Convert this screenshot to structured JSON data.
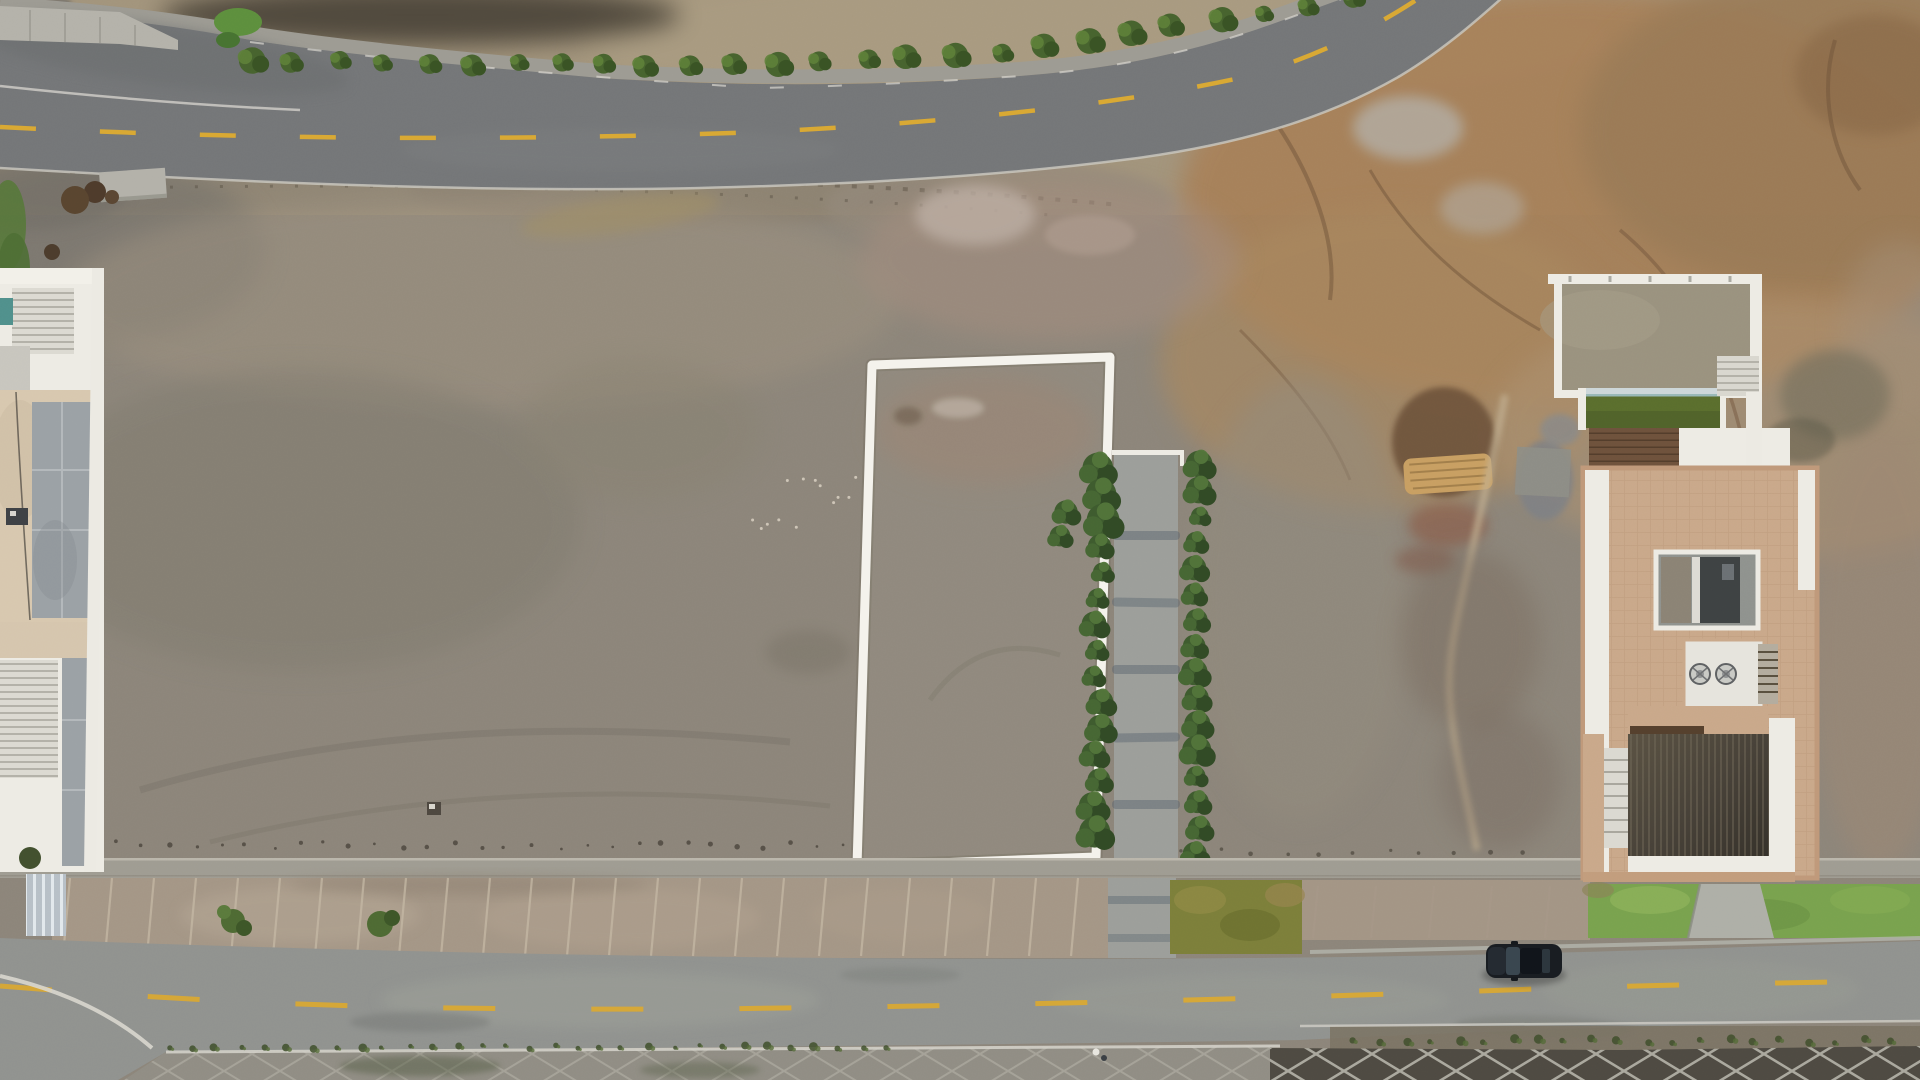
{
  "meta": {
    "kind": "aerial-drone-photograph",
    "subject": "vacant sandy desert lot with a white-outlined property parcel between two paved roads",
    "visible_text": "none"
  },
  "palette": {
    "lot_base": "#8c857a",
    "hill_tan": "#a2947c",
    "terrain_orange": "#a78058",
    "terrain_brown": "#9a7a57",
    "embankment": "#8c8373",
    "asphalt_top": "#747678",
    "asphalt_shoulder": "#6b6d6e",
    "asphalt_bottom": "#90928f",
    "curb_stone": "#9d9b93",
    "road_yellow": "#d9a833",
    "road_white": "#d8d6cf",
    "outline_white": "#f4f2ec",
    "bush_green": "#47632e",
    "bush_light": "#5d7f39",
    "hedge_green": "#3e5b2e",
    "hedge_dark": "#314a25",
    "grass_green": "#79a24e",
    "grass_light": "#8fb35b",
    "olive_grass": "#7c7f3a",
    "weed_green": "#3f4f2c",
    "sidewalk": "#9f9c92",
    "paver": "#9c9e9a",
    "paver_streak": "#5c6670",
    "diamond_dark": "#4e4a42",
    "diamond_line": "#aaa89e",
    "strip_dirt": "#a49686",
    "strip_line": "#c4b8a4",
    "white_struct": "#edebe4",
    "roof_tan": "#c9a88a",
    "pool_green": "#5a6e2d",
    "pool_coping": "#cdd7d9",
    "teal_pool": "#50908c",
    "deck_brown": "#6e523c",
    "pergola_dark": "#474138",
    "slate_gray": "#9ba1a5",
    "beige_panel": "#d8c8af",
    "kitchen_dark": "#3e4243",
    "car_body": "#181c21",
    "car_glass": "#39464f",
    "sand_path": "#c3b193",
    "sand_ridge": "#c89f62",
    "mound_brown": "#6b4f38"
  },
  "scene": {
    "property_outline": {
      "shape": "quadrilateral",
      "stroke": "white",
      "corners_px": [
        [
          872,
          365
        ],
        [
          1110,
          357
        ],
        [
          1096,
          857
        ],
        [
          857,
          866
        ]
      ]
    },
    "top_road": {
      "surface": "asphalt",
      "centerline": "dashed-yellow",
      "edges": "white-lines",
      "roadside": "stone-curb-with-shrub-row",
      "grass_clump": "top-left"
    },
    "bottom_road": {
      "surface": "asphalt",
      "centerline": "dashed-yellow",
      "parked_car": {
        "color": "black",
        "position_px": [
          1486,
          944
        ]
      },
      "pedestrians_px": [
        [
          1096,
          1052
        ],
        [
          1104,
          1058
        ]
      ]
    },
    "hedged_walkway": {
      "orientation": "vertical",
      "location": "right-of-property-outline",
      "hedge_rows": 2,
      "paved_center": true
    },
    "buildings": {
      "left_edge_house": {
        "features": [
          "slatted-pergola-roof",
          "slate-panels",
          "beige-terrace",
          "small-teal-pool",
          "striped-driveway"
        ]
      },
      "right_house": {
        "features": [
          "walled-garden",
          "green-lap-pool",
          "wood-deck",
          "white-terrace",
          "tan-tiled-roof",
          "open-courtyard-kitchen",
          "twin-roof-fans",
          "dark-pergola",
          "lawn",
          "concrete-driveway"
        ]
      }
    },
    "ground_zones": [
      "taupe-sand-lot",
      "tan-hill-above-road",
      "orange-brown-eroded-terrain",
      "pink-mauve-patch",
      "plot-division-strip",
      "olive-grass-patch",
      "diamond-paver-sidewalk"
    ]
  }
}
